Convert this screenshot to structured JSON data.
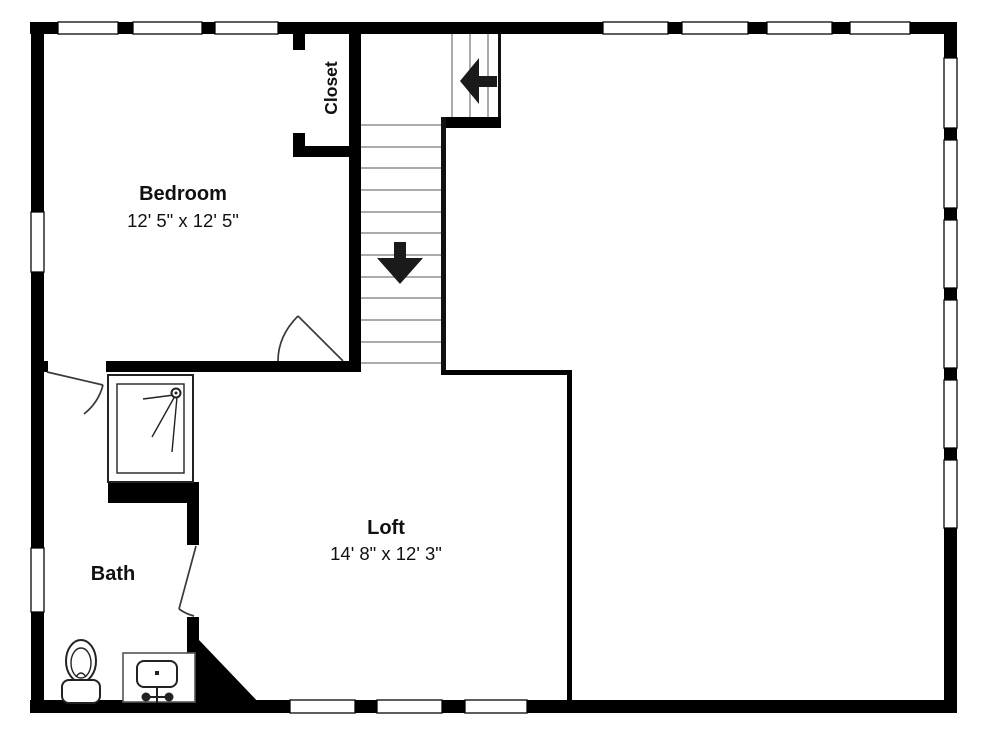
{
  "plan_title": "Upper floor plan",
  "colors": {
    "background": "#ffffff",
    "wall": "#000000",
    "tread": "#8f8f8f",
    "text": "#111111"
  },
  "rooms": {
    "bedroom": {
      "label": "Bedroom",
      "dims": "12' 5\" x 12' 5\""
    },
    "closet": {
      "label": "Closet"
    },
    "bath": {
      "label": "Bath"
    },
    "loft": {
      "label": "Loft",
      "dims": "14' 8\" x 12' 3\""
    }
  },
  "stairs": {
    "lower_flight_treads": 12,
    "upper_flight_treads": 4,
    "up_arrow_direction": "left",
    "down_arrow_direction": "down"
  },
  "fixtures": [
    "toilet",
    "sink-vanity",
    "shower"
  ],
  "windows": {
    "top": 7,
    "left": 2,
    "right": 6,
    "bottom": 3
  }
}
